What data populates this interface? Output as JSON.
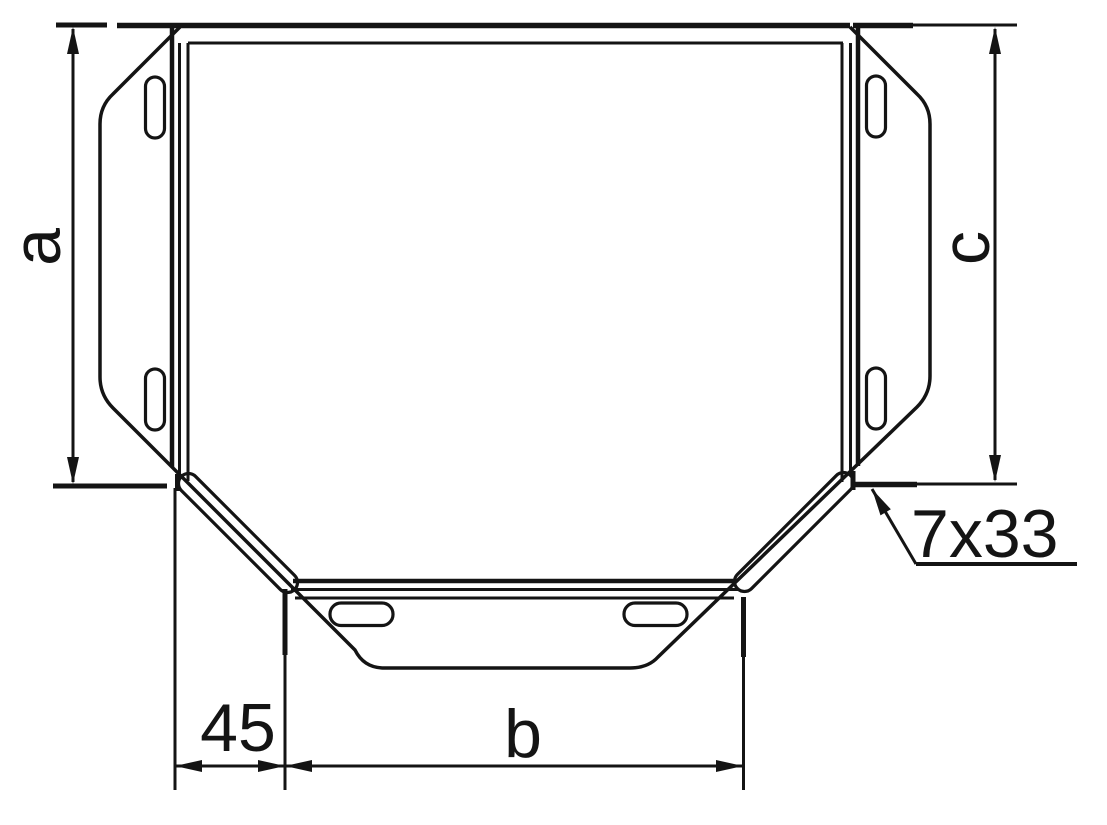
{
  "colors": {
    "ink": "#141414",
    "paper": "#ffffff"
  },
  "labels": {
    "dim_a": "a",
    "dim_b": "b",
    "dim_c": "c",
    "dim_offset": "45",
    "slot_size": "7x33"
  }
}
